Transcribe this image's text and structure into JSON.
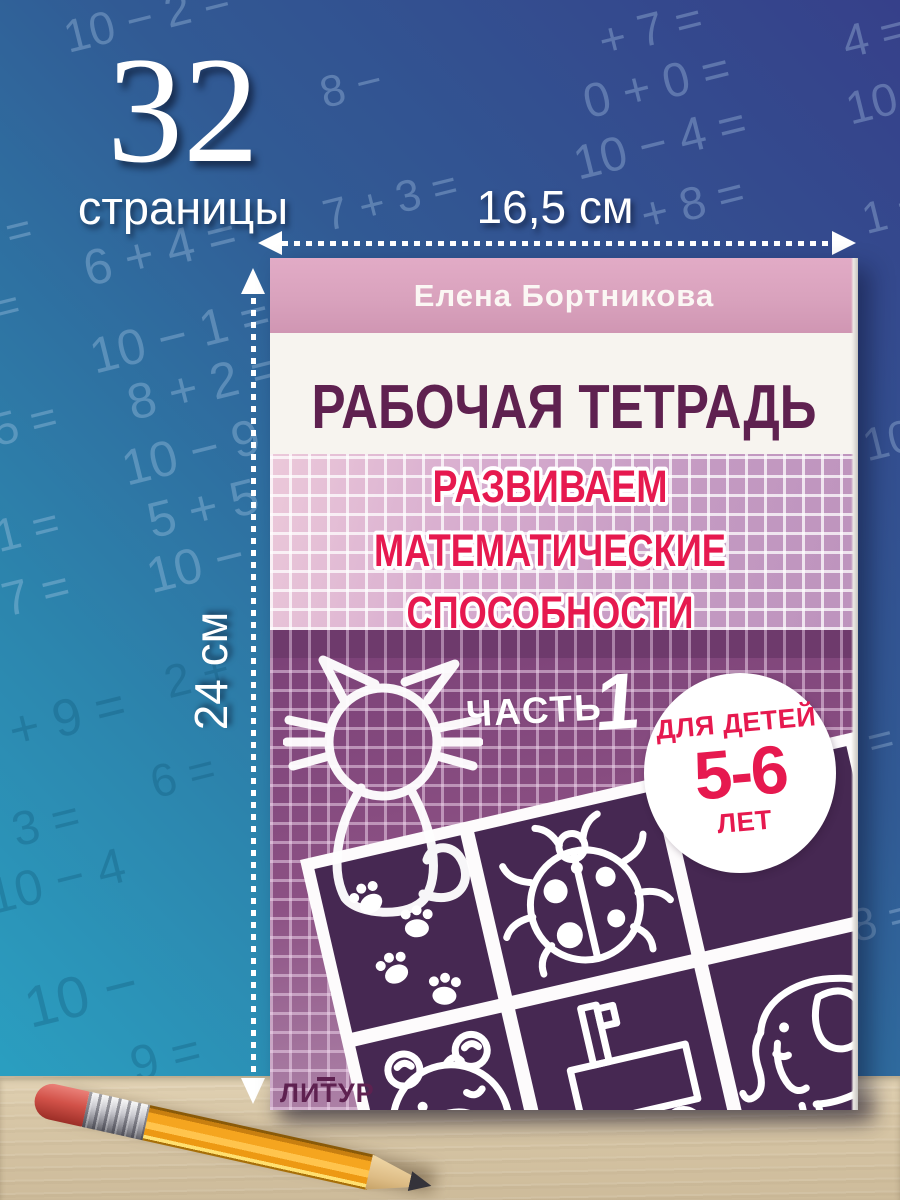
{
  "annotations": {
    "page_count": "32",
    "page_count_label": "страницы",
    "width_label": "16,5 см",
    "height_label": "24 см"
  },
  "book": {
    "author": "Елена Бортникова",
    "series_title": "РАБОЧАЯ ТЕТРАДЬ",
    "title_lines": [
      "РАЗВИВАЕМ",
      "МАТЕМАТИЧЕСКИЕ",
      "СПОСОБНОСТИ"
    ],
    "part_label": "ЧАСТЬ",
    "part_number": "1",
    "age_badge": {
      "line1": "для детей",
      "line2": "5-6",
      "line3": "лет"
    },
    "publisher": "ЛИТУР",
    "cover_illustrations": [
      "cat",
      "paw-prints",
      "ladybug",
      "bear",
      "cart",
      "elephant"
    ],
    "colors": {
      "accent_red": "#e6194f",
      "title_purple": "#5f2150",
      "cover_pink": "#d9a2bd",
      "panel_purple": "#462852",
      "background_blue_top": "#36408a",
      "background_teal_bottom": "#2aa5c5",
      "desk_beige": "#d8c7a7"
    }
  },
  "background": {
    "equations": [
      {
        "t": "10 − 2 =",
        "x": 62,
        "y": -10,
        "s": 46,
        "tone": "light"
      },
      {
        "t": "8 −",
        "x": 320,
        "y": 62,
        "s": 44,
        "tone": "light"
      },
      {
        "t": "+ 7 =",
        "x": 598,
        "y": 2,
        "s": 46,
        "tone": "light"
      },
      {
        "t": "4 =",
        "x": 842,
        "y": 8,
        "s": 46,
        "tone": "light"
      },
      {
        "t": "0 + 0 =",
        "x": 582,
        "y": 58,
        "s": 48,
        "tone": "light"
      },
      {
        "t": "10",
        "x": 846,
        "y": 76,
        "s": 46,
        "tone": "light"
      },
      {
        "t": "10 − 4 =",
        "x": 572,
        "y": 116,
        "s": 48,
        "tone": "light"
      },
      {
        "t": "+ 8 =",
        "x": 640,
        "y": 176,
        "s": 46,
        "tone": "light"
      },
      {
        "t": "1 =",
        "x": 862,
        "y": 188,
        "s": 44,
        "tone": "light"
      },
      {
        "t": "7 + 3 =",
        "x": 322,
        "y": 176,
        "s": 44,
        "tone": "light"
      },
      {
        "t": "=",
        "x": 6,
        "y": 206,
        "s": 44,
        "tone": "light"
      },
      {
        "t": "6 + 4 =",
        "x": 82,
        "y": 222,
        "s": 50,
        "tone": "light"
      },
      {
        "t": "=",
        "x": -6,
        "y": 282,
        "s": 44,
        "tone": "light"
      },
      {
        "t": "10 − 1 =",
        "x": 88,
        "y": 306,
        "s": 50,
        "tone": "light"
      },
      {
        "t": "8 + 2 =",
        "x": 126,
        "y": 356,
        "s": 50,
        "tone": "light"
      },
      {
        "t": "5 =",
        "x": -8,
        "y": 396,
        "s": 46,
        "tone": "light"
      },
      {
        "t": "10 − 9 =",
        "x": 120,
        "y": 418,
        "s": 50,
        "tone": "light"
      },
      {
        "t": "5 + 5 =",
        "x": 146,
        "y": 474,
        "s": 50,
        "tone": "light"
      },
      {
        "t": "1 =",
        "x": -6,
        "y": 502,
        "s": 46,
        "tone": "light"
      },
      {
        "t": "10 −",
        "x": 146,
        "y": 536,
        "s": 50,
        "tone": "light"
      },
      {
        "t": "7 =",
        "x": 2,
        "y": 566,
        "s": 48,
        "tone": "light"
      },
      {
        "t": "2 +",
        "x": 164,
        "y": 648,
        "s": 46,
        "tone": "dark"
      },
      {
        "t": "+ 9 =",
        "x": 8,
        "y": 688,
        "s": 52,
        "tone": "dark"
      },
      {
        "t": "6 =",
        "x": 150,
        "y": 748,
        "s": 46,
        "tone": "dark"
      },
      {
        "t": "3 =",
        "x": 12,
        "y": 796,
        "s": 48,
        "tone": "dark"
      },
      {
        "t": "10 − 4",
        "x": -14,
        "y": 852,
        "s": 50,
        "tone": "dark"
      },
      {
        "t": "10 −",
        "x": 24,
        "y": 962,
        "s": 58,
        "tone": "dark"
      },
      {
        "t": "9 =",
        "x": 130,
        "y": 1028,
        "s": 50,
        "tone": "dark"
      },
      {
        "t": "10 −",
        "x": 862,
        "y": 408,
        "s": 46,
        "tone": "light"
      },
      {
        "t": "=",
        "x": 868,
        "y": 716,
        "s": 44,
        "tone": "light"
      },
      {
        "t": "8 =",
        "x": 850,
        "y": 892,
        "s": 46,
        "tone": "light"
      }
    ]
  }
}
